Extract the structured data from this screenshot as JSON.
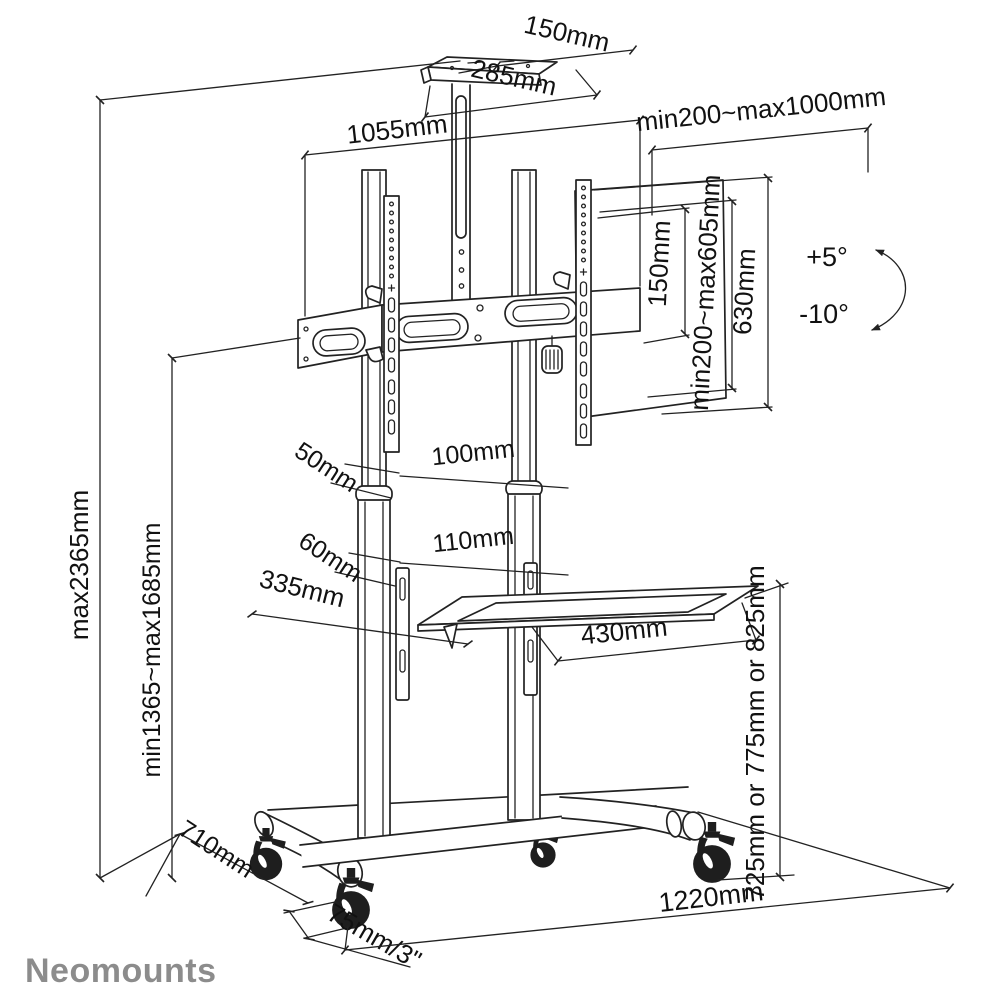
{
  "brand": {
    "name": "Neomounts",
    "color": "#8c8c8c"
  },
  "colors": {
    "line": "#222222",
    "background": "#ffffff",
    "label": "#111111"
  },
  "dimensions": {
    "top_shelf_depth": "150mm",
    "top_shelf_width": "285mm",
    "crossbar_width": "1055mm",
    "vesa_width_range": "min200~max1000mm",
    "bracket_top_offset": "150mm",
    "vesa_height_range": "min200~max605mm",
    "bracket_height": "630mm",
    "tilt_up": "+5°",
    "tilt_down": "-10°",
    "total_height_max": "max2365mm",
    "screen_center_height_range": "min1365~max1685mm",
    "upper_clamp_depth": "50mm",
    "upper_clamp_width": "100mm",
    "lower_clamp_depth": "60mm",
    "lower_clamp_width": "110mm",
    "shelf_depth": "335mm",
    "shelf_width": "430mm",
    "shelf_heights": "725mm or 775mm or 825mm",
    "base_depth": "710mm",
    "base_width": "1220mm",
    "caster_diameter": "75mm/3\""
  }
}
